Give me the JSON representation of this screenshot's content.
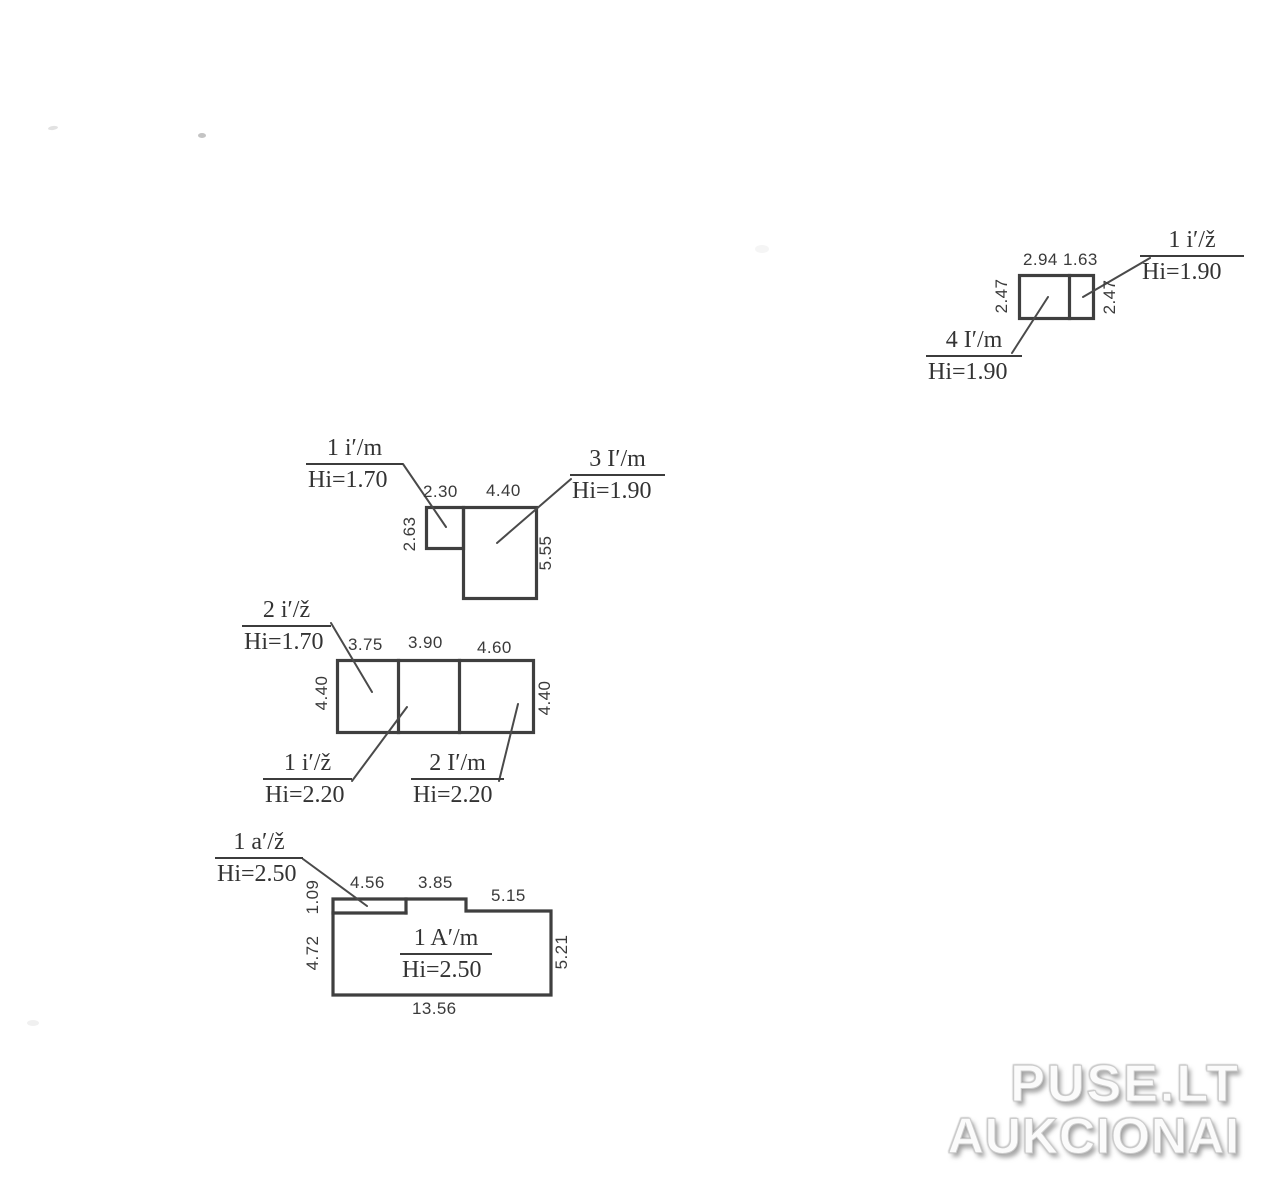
{
  "page": {
    "background": "#ffffff",
    "ink_color": "#3f3f3f"
  },
  "watermark": {
    "line1": "PUSE.LT",
    "line2": "AUKCIONAI"
  },
  "unit_top_right": {
    "dims": {
      "top_left_cell": "2.94",
      "top_right_cell": "1.63",
      "left": "2.47",
      "right": "2.47"
    },
    "label_upper": {
      "code": "1 i′/ž",
      "height": "Hi=1.90"
    },
    "label_lower": {
      "code": "4 I′/m",
      "height": "Hi=1.90"
    }
  },
  "unit_l_shape": {
    "dims": {
      "top_small": "2.30",
      "top_large": "4.40",
      "left": "2.63",
      "right": "5.55"
    },
    "label_left": {
      "code": "1 i′/m",
      "height": "Hi=1.70"
    },
    "label_right": {
      "code": "3 I′/m",
      "height": "Hi=1.90"
    }
  },
  "unit_three_cell": {
    "dims": {
      "top_1": "3.75",
      "top_2": "3.90",
      "top_3": "4.60",
      "left": "4.40",
      "right": "4.40"
    },
    "label_top": {
      "code": "2 i′/ž",
      "height": "Hi=1.70"
    },
    "label_bottom_left": {
      "code": "1 i′/ž",
      "height": "Hi=2.20"
    },
    "label_bottom_right": {
      "code": "2 I′/m",
      "height": "Hi=2.20"
    }
  },
  "unit_bottom": {
    "dims": {
      "top_1": "4.56",
      "top_2": "3.85",
      "top_3": "5.15",
      "left_upper": "1.09",
      "left_lower": "4.72",
      "right": "5.21",
      "bottom": "13.56"
    },
    "label_top": {
      "code": "1 a′/ž",
      "height": "Hi=2.50"
    },
    "label_inside": {
      "code": "1 A′/m",
      "height": "Hi=2.50"
    }
  }
}
